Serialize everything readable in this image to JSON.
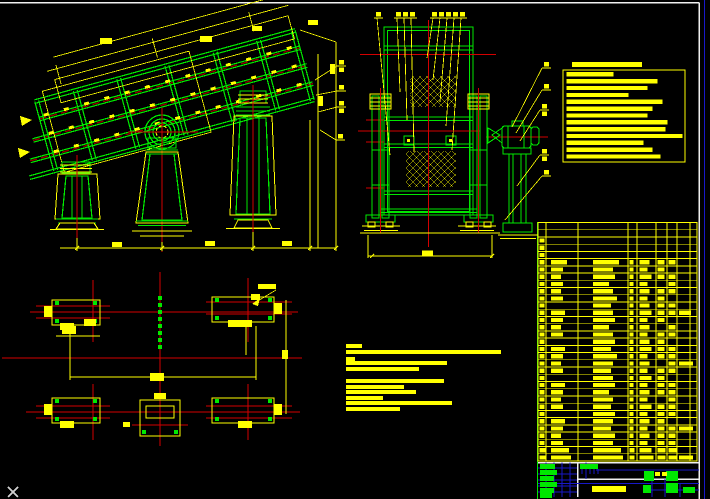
{
  "window": {
    "kind": "cad-drawing-viewport",
    "background": "#000000",
    "cursor_visible": true
  },
  "colors": {
    "background": "#000000",
    "geometry_green": "#00e800",
    "annotation_yellow": "#ffff00",
    "centerline_red": "#d40000",
    "hidden_darkred": "#8f0000",
    "titleblock_blue": "#1818c8",
    "sheet_border_white": "#f0f0f0",
    "cursor_gray": "#cfcfcf"
  },
  "views": {
    "side_view": "inclined vibrating-screen side elevation",
    "front_view": "vibrating-screen end elevation with drive motor",
    "plan_view": "foundation plan with anchor pads",
    "notes_box": "technical requirements list (illegible small text)",
    "parts_table": "bill of materials grid (illegible small text)",
    "title_block": "drawing title block (illegible small text)"
  },
  "technical_requirements_box": {
    "x": 563,
    "y": 70,
    "w": 122,
    "h": 92,
    "title_bar": {
      "x": 572,
      "y": 62,
      "w": 70,
      "h": 5
    },
    "line_start_x": 566.5,
    "first_line_y": 72.2,
    "line_step": 6.85,
    "line_h": 4.3,
    "line_widths": [
      47,
      91,
      81,
      62,
      96,
      86,
      81,
      101,
      99,
      116,
      77,
      86,
      94
    ]
  },
  "notes_block": {
    "x": 346,
    "bar_h": 4,
    "bars": [
      [
        344,
        16
      ],
      [
        350,
        155
      ],
      [
        357,
        9
      ],
      [
        361,
        101
      ],
      [
        367,
        73
      ],
      [
        379,
        98
      ],
      [
        385,
        58
      ],
      [
        390,
        70
      ],
      [
        396,
        37
      ],
      [
        401,
        106
      ],
      [
        407,
        54
      ]
    ]
  },
  "parts_table": {
    "x": 538,
    "y": 222.5,
    "right": 697,
    "bottom": 461,
    "row_count": 33,
    "col_edges": [
      538,
      546,
      578,
      628,
      637,
      656,
      667,
      677,
      690,
      697
    ],
    "blob_col_x": [
      539.5,
      551,
      593,
      629.5,
      639.5,
      657.5,
      668.5,
      679
    ],
    "blob_h": 4.2,
    "rows": [
      [
        0,
        0,
        0,
        0,
        0,
        0,
        0,
        0
      ],
      [
        0,
        0,
        0,
        0,
        0,
        0,
        0,
        0
      ],
      [
        5,
        0,
        0,
        0,
        0,
        0,
        0,
        0
      ],
      [
        5,
        0,
        0,
        0,
        0,
        0,
        0,
        0
      ],
      [
        5,
        0,
        0,
        0,
        0,
        0,
        0,
        0
      ],
      [
        5,
        16,
        26,
        4,
        10,
        7,
        7,
        0
      ],
      [
        5,
        12,
        20,
        4,
        8,
        7,
        0,
        0
      ],
      [
        5,
        10,
        22,
        4,
        12,
        7,
        7,
        0
      ],
      [
        5,
        12,
        16,
        4,
        8,
        0,
        7,
        0
      ],
      [
        5,
        10,
        20,
        4,
        10,
        7,
        7,
        0
      ],
      [
        5,
        12,
        24,
        4,
        8,
        7,
        0,
        0
      ],
      [
        5,
        0,
        18,
        4,
        10,
        7,
        7,
        0
      ],
      [
        5,
        14,
        20,
        4,
        12,
        7,
        7,
        12
      ],
      [
        5,
        12,
        22,
        4,
        8,
        7,
        0,
        0
      ],
      [
        5,
        10,
        16,
        4,
        10,
        0,
        7,
        0
      ],
      [
        5,
        12,
        20,
        4,
        8,
        7,
        7,
        0
      ],
      [
        5,
        0,
        22,
        4,
        10,
        7,
        0,
        0
      ],
      [
        5,
        14,
        18,
        4,
        12,
        7,
        7,
        0
      ],
      [
        5,
        12,
        24,
        4,
        8,
        7,
        7,
        0
      ],
      [
        5,
        10,
        20,
        4,
        10,
        0,
        7,
        14
      ],
      [
        5,
        12,
        18,
        4,
        8,
        7,
        7,
        0
      ],
      [
        5,
        0,
        20,
        4,
        12,
        7,
        0,
        0
      ],
      [
        5,
        14,
        22,
        4,
        8,
        7,
        7,
        0
      ],
      [
        5,
        12,
        16,
        4,
        10,
        7,
        7,
        0
      ],
      [
        5,
        10,
        20,
        4,
        8,
        0,
        7,
        0
      ],
      [
        5,
        12,
        18,
        4,
        12,
        7,
        7,
        0
      ],
      [
        5,
        0,
        22,
        4,
        8,
        7,
        7,
        0
      ],
      [
        5,
        14,
        20,
        4,
        10,
        7,
        0,
        0
      ],
      [
        5,
        12,
        18,
        4,
        8,
        7,
        7,
        14
      ],
      [
        5,
        10,
        22,
        4,
        10,
        7,
        7,
        0
      ],
      [
        5,
        12,
        20,
        4,
        8,
        7,
        7,
        0
      ],
      [
        6,
        18,
        28,
        5,
        12,
        8,
        8,
        0
      ],
      [
        6,
        20,
        30,
        5,
        14,
        8,
        8,
        14
      ]
    ]
  },
  "callouts": {
    "top": [
      {
        "x": 376,
        "y": 12,
        "tx": 390,
        "ty": 155
      },
      {
        "x": 396,
        "y": 12,
        "tx": 400,
        "ty": 92
      },
      {
        "x": 403,
        "y": 12,
        "tx": 407,
        "ty": 120
      },
      {
        "x": 410,
        "y": 12,
        "tx": 414,
        "ty": 152
      },
      {
        "x": 432,
        "y": 12,
        "tx": 427,
        "ty": 58
      },
      {
        "x": 439,
        "y": 12,
        "tx": 433,
        "ty": 80
      },
      {
        "x": 446,
        "y": 12,
        "tx": 440,
        "ty": 102
      },
      {
        "x": 453,
        "y": 12,
        "tx": 446,
        "ty": 126
      },
      {
        "x": 460,
        "y": 12,
        "tx": 452,
        "ty": 150
      }
    ],
    "right": [
      {
        "x": 544,
        "y": 62,
        "tx": 512,
        "ty": 127
      },
      {
        "x": 544,
        "y": 84,
        "tx": 516,
        "ty": 133
      },
      {
        "x": 542,
        "y": 104,
        "stack": true,
        "tx": 520,
        "ty": 141
      },
      {
        "x": 542,
        "y": 149,
        "stack": true,
        "tx": 517,
        "ty": 186
      },
      {
        "x": 544,
        "y": 170,
        "tx": 505,
        "ty": 220
      }
    ],
    "side": [
      {
        "x": 339,
        "y": 60,
        "stack": true,
        "tx": 315,
        "ty": 80
      },
      {
        "x": 339,
        "y": 85,
        "tx": 316,
        "ty": 95
      },
      {
        "x": 339,
        "y": 101,
        "stack": true,
        "tx": 318,
        "ty": 112
      },
      {
        "x": 338,
        "y": 134,
        "tx": 320,
        "ty": 130
      }
    ]
  },
  "deck_ticks": {
    "rows": [
      80,
      99,
      118
    ],
    "x_start": 35,
    "x_end": 295,
    "step": 21,
    "w": 5,
    "h": 3
  },
  "cursor": {
    "x": 8,
    "y": 487,
    "size": 10
  }
}
